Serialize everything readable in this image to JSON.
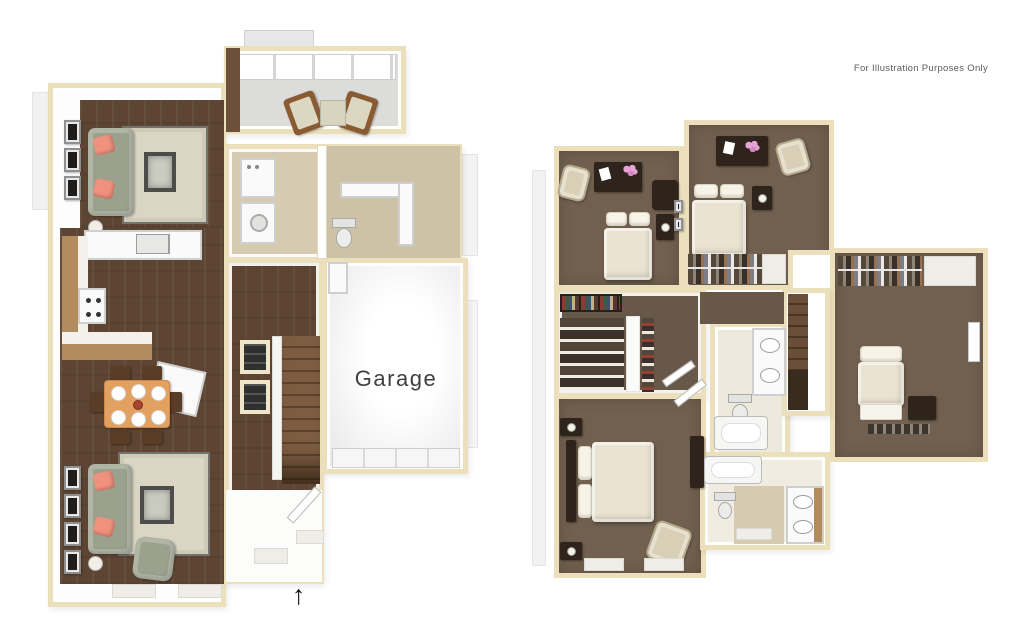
{
  "annotations": {
    "disclaimer": "For Illustration Purposes Only",
    "garage_label": "Garage",
    "entry_arrow": "↑"
  },
  "palette": {
    "wall_outline": "#EBDFBC",
    "wood_floor": "#5E4533",
    "carpet": "#71604F",
    "carpet_dark": "#685849",
    "tile_beige": "#D6CBB0",
    "tile_beige_dark": "#CDC2A6",
    "rug_beige": "#DBD6C4",
    "sofa_green": "#9BA18D",
    "pillow_salmon": "#F0917E",
    "cabinet_wood": "#B28C5C",
    "dining_table": "#E2A161",
    "bed_cream": "#EAE3D1",
    "pillow_white": "#F7F3E8",
    "furn_dark": "#2E241C",
    "flower_pink": "#E7A3D3",
    "chair_beige": "#D9CFB6",
    "sunroom_floor": "#DCDCDA",
    "garage_text": "#3F3F3F",
    "disclaimer_color": "#5C5C5C"
  }
}
